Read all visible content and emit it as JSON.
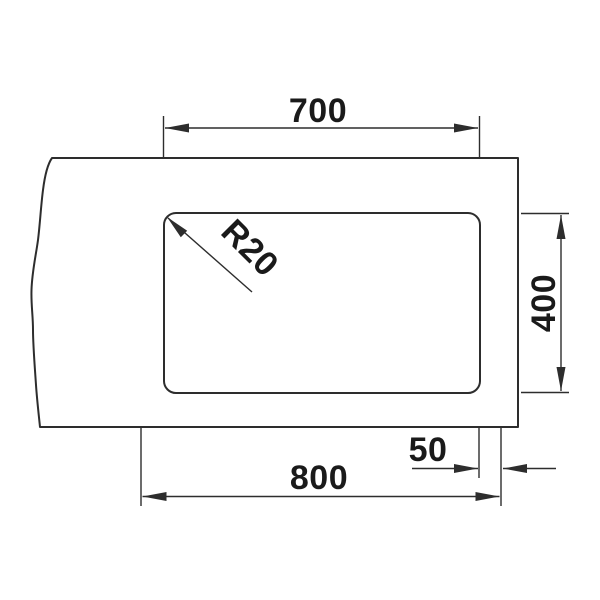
{
  "drawing": {
    "colors": {
      "line": "#2d2d2d",
      "text": "#1a1a1a",
      "background": "#ffffff"
    },
    "dimensions": {
      "cutout_width": "700",
      "cutout_height": "400",
      "corner_radius": "R20",
      "overall_width": "800",
      "side_offset": "50"
    }
  }
}
